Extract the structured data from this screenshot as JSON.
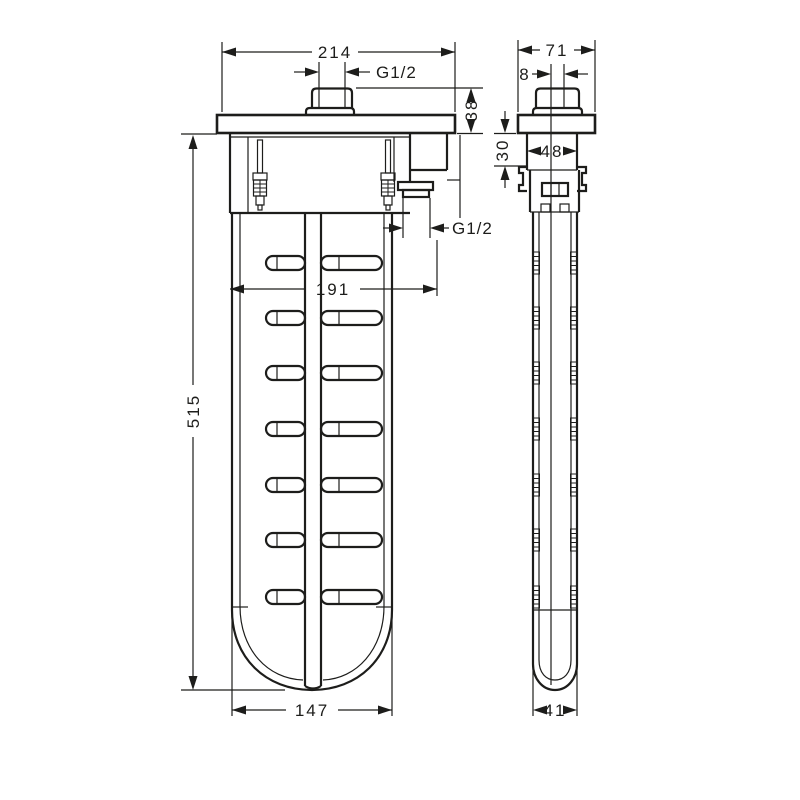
{
  "drawing": {
    "front": {
      "top_width": "214",
      "top_thread": "G1/2",
      "flange_height": "38",
      "outlet_thread": "G1/2",
      "outlet_distance": "191",
      "length": "515",
      "bottom_width": "147"
    },
    "side": {
      "top_width": "71",
      "offset": "8",
      "drop": "30",
      "body_width": "48",
      "tube_width": "41"
    },
    "colors": {
      "line": "#1d1d1b",
      "background": "#ffffff"
    }
  }
}
